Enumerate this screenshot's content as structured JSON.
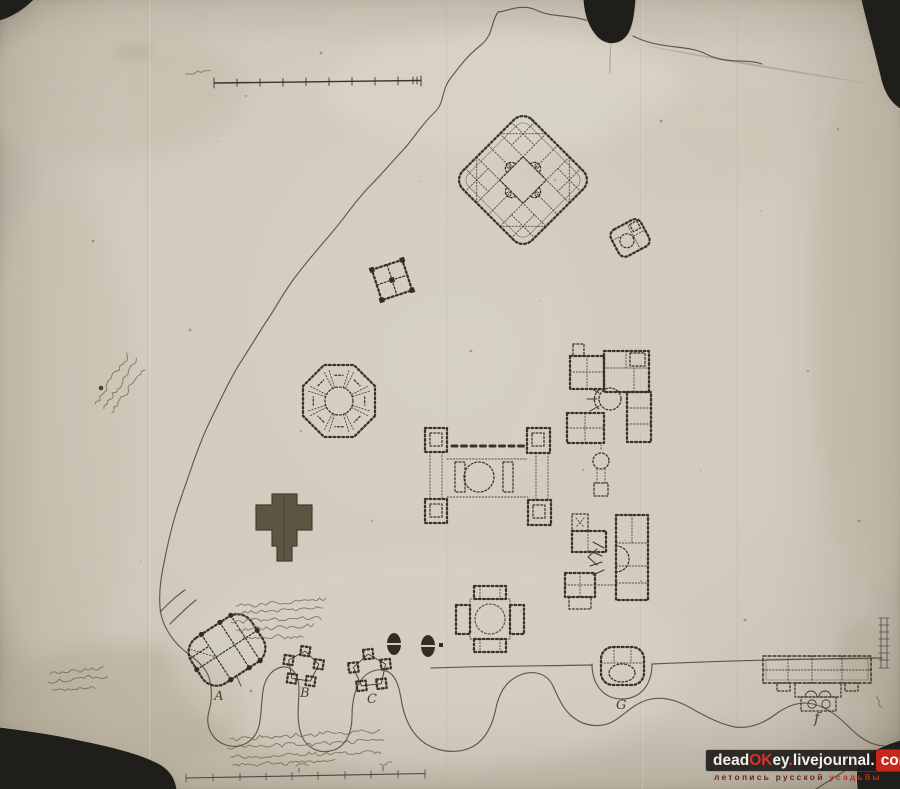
{
  "plan_labels": {
    "a": "А",
    "b": "В",
    "c": "С",
    "g": "G",
    "f": "f"
  },
  "watermark": {
    "site": {
      "p1": "dead",
      "p2": "OK",
      "p3": "ey",
      "p4": ".",
      "p5": "livejournal",
      "p6": ".",
      "p7": "com"
    },
    "tagline": {
      "left": "летопись русской",
      "right": "усадьбы"
    }
  },
  "colors": {
    "paper": "#d2ccbf",
    "ink": "#3a332a",
    "boundary": "#4a4336",
    "solid_building": "#59523e",
    "watermark_bar": "#1e1b18",
    "watermark_red": "#c7271c",
    "watermark_text": "#f2efe9",
    "tagline_dark": "#6e2218",
    "tagline_red": "#c0301d",
    "background": "#1f1e1b"
  }
}
